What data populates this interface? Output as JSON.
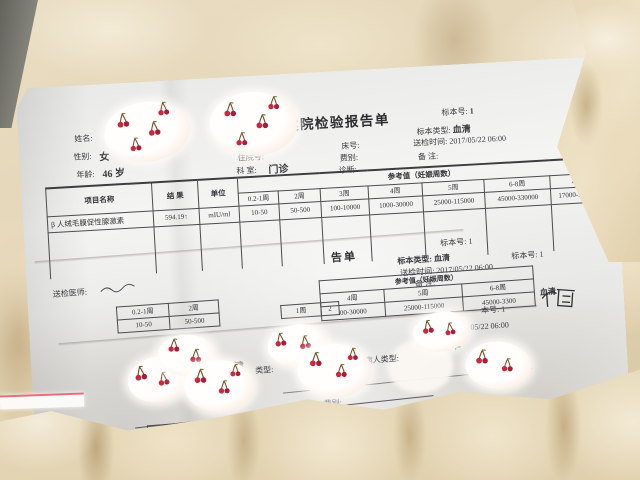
{
  "sheet1": {
    "title": "妇幼保健院检验报告单",
    "fields": {
      "name_label": "姓名:",
      "sex_label": "性别:",
      "sex_value": "女",
      "age_label": "年龄:",
      "age_value": "46 岁",
      "patient_type_label": "病人类型:",
      "inpatient_no_label": "住院号:",
      "dept_label": "科 室:",
      "dept_value": "门诊",
      "bed_label": "床号:",
      "fee_label": "费别:",
      "diagnosis_label": "诊断:"
    },
    "specimen": {
      "no_label": "标本号:",
      "no_value": "1",
      "type_label": "标本类型:",
      "type_value": "血清",
      "time_label": "送检时间:",
      "time_value": "2017/05/22 06:00",
      "note_label": "备 注:"
    },
    "table": {
      "item_header": "项目名称",
      "result_header": "结 果",
      "unit_header": "单位",
      "ref_header": "参考值（妊娠周数）",
      "week_headers": [
        "0.2-1周",
        "2周",
        "3周",
        "4周",
        "5周",
        "6-8周",
        "12周"
      ],
      "row": {
        "item": "β 人绒毛膜促性腺激素",
        "result": "594.19↑",
        "unit": "mIU/ml",
        "refs": [
          "10-50",
          "50-500",
          "100-10000",
          "1000-30000",
          "25000-115000",
          "45000-330000",
          "17000-250000"
        ]
      }
    },
    "footer": {
      "sender_label": "送检医师:"
    }
  },
  "sheet2": {
    "title_fragment": "告单",
    "specimen": {
      "no_line": "标本号: 1",
      "type_line": "标本类型: 血清",
      "time_line": "送检时间: 2017/05/22 06:00",
      "note_line": "备 注:"
    },
    "table": {
      "ref_header": "参考值（妊娠周数）",
      "left_weeks": [
        "0.2-1周",
        "2周"
      ],
      "left_values": [
        "10-50",
        "50-500"
      ],
      "mid_fragments": [
        "1周",
        "2"
      ],
      "right_weeks": [
        "4周",
        "5周",
        "6-8周"
      ],
      "right_values": [
        "00-30000",
        "25000-115000",
        "45000-3300"
      ]
    },
    "fragments": {
      "serum": "血清",
      "specimen_no": "标本号: 1"
    }
  },
  "sheet3": {
    "title_fragments": {
      "a": "幼保健",
      "b": "类型:",
      "c": "病人类型:",
      "d": "单"
    },
    "fee_label": "费别:",
    "diagnosis_label": "诊断:",
    "week_fragment": "0.2-1周",
    "value_fragment": "0-50",
    "specimen_no_fragment": "本号: 1",
    "time_fragment": "/05/22 06:00"
  }
}
